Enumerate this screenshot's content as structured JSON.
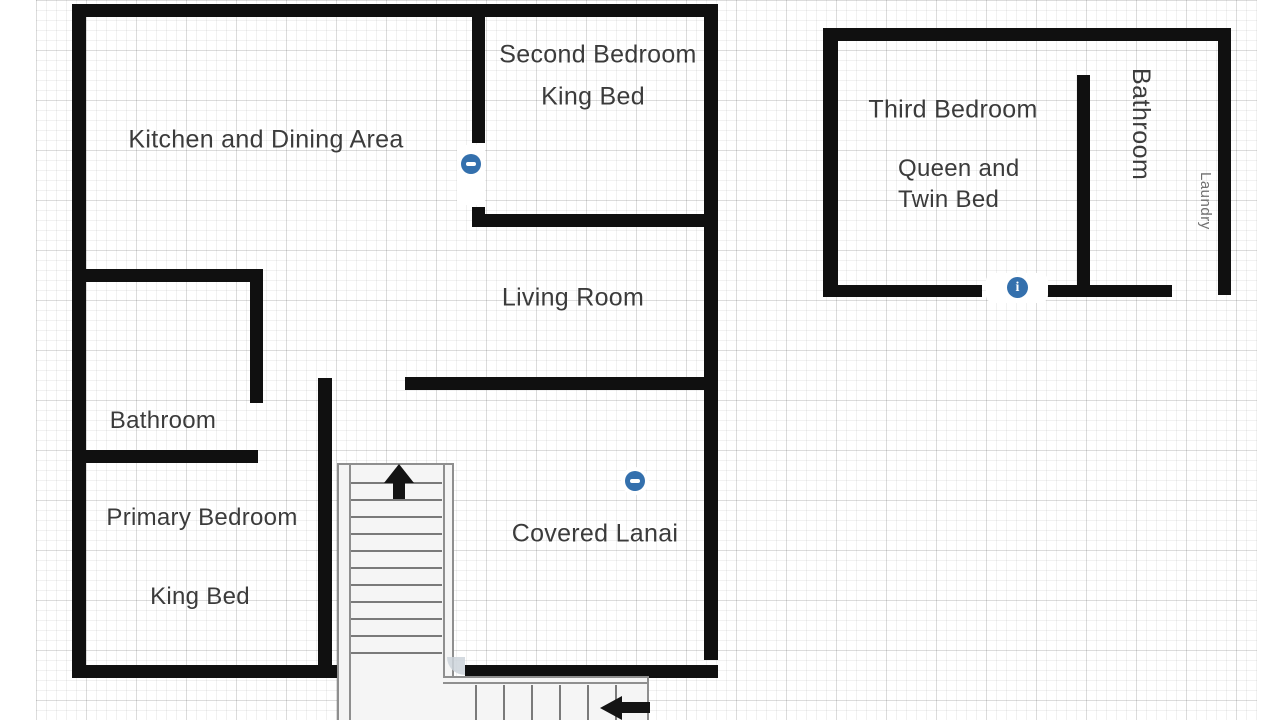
{
  "rooms": {
    "kitchen": {
      "label": "Kitchen and Dining Area"
    },
    "second_bedroom": {
      "label": "Second Bedroom",
      "bed": "King Bed"
    },
    "living_room": {
      "label": "Living Room"
    },
    "bathroom_left": {
      "label": "Bathroom"
    },
    "primary_bedroom": {
      "label": "Primary Bedroom",
      "bed": "King Bed"
    },
    "covered_lanai": {
      "label": "Covered Lanai"
    },
    "third_bedroom": {
      "label": "Third Bedroom",
      "bed": "Queen and\nTwin Bed"
    },
    "bathroom_right": {
      "label": "Bathroom"
    },
    "laundry": {
      "label": "Laundry"
    }
  },
  "icons": {
    "info_glyph": "i"
  },
  "colors": {
    "wall": "#101010",
    "marker_blue": "#3470ad",
    "text": "#3b3b3b",
    "grid_line": "#e9e9e9"
  }
}
